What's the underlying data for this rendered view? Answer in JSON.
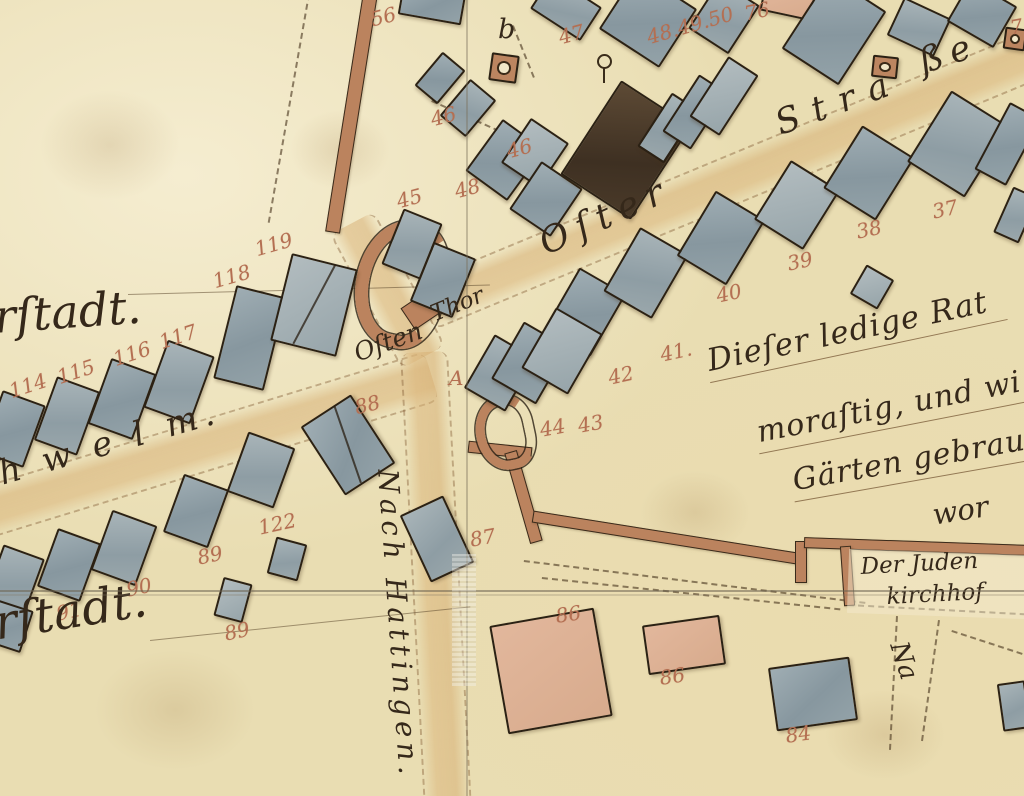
{
  "colors": {
    "parchment": "#e9ddb2",
    "building_blue": "#8f9fa8",
    "building_dark": "#4a3a29",
    "building_pink": "#dcb096",
    "wall_brown": "#bb835e",
    "number_red": "#b46f52",
    "ink": "#35281a"
  },
  "street_name": "Oſter Straße",
  "labels": [
    {
      "id": "vorstadt-label-top",
      "text": "rſtadt.",
      "x": -8,
      "y": 290,
      "rot": -4,
      "size": 46
    },
    {
      "id": "schwelm-road-label",
      "text": "h w e l m.",
      "x": -6,
      "y": 455,
      "rot": -16,
      "size": 34,
      "ls": 6
    },
    {
      "id": "vorstadt-label-bottom",
      "text": "rſtadt.",
      "x": -10,
      "y": 596,
      "rot": -9,
      "size": 48
    },
    {
      "id": "osten-thor-word1",
      "text": "Oſten",
      "x": 350,
      "y": 340,
      "rot": -20,
      "size": 25
    },
    {
      "id": "osten-thor-word2",
      "text": "Thor",
      "x": 427,
      "y": 303,
      "rot": -22,
      "size": 23
    },
    {
      "id": "street-name-oster",
      "text": "Oſter",
      "x": 533,
      "y": 226,
      "rot": -24,
      "size": 36,
      "ls": 9
    },
    {
      "id": "street-name-stra",
      "text": "Stra",
      "x": 770,
      "y": 106,
      "rot": -20,
      "size": 35,
      "ls": 14
    },
    {
      "id": "street-name-sse",
      "text": "ße",
      "x": 914,
      "y": 44,
      "rot": -18,
      "size": 35,
      "ls": 8
    },
    {
      "id": "nach-hattingen-road-label",
      "text": "Nach Hattingen.",
      "x": 404,
      "y": 468,
      "rot": 86,
      "size": 28,
      "ls": 5
    },
    {
      "id": "note-line-1",
      "text": "Dieſer ledige Rat",
      "x": 702,
      "y": 344,
      "rot": -12,
      "size": 31,
      "ls": 1,
      "cls": "underl"
    },
    {
      "id": "note-line-2",
      "text": "moraſtig, und wi",
      "x": 752,
      "y": 416,
      "rot": -11,
      "size": 30,
      "ls": 1,
      "cls": "underl"
    },
    {
      "id": "note-line-3",
      "text": "Gärten gebrau",
      "x": 788,
      "y": 464,
      "rot": -10,
      "size": 30,
      "ls": 1,
      "cls": "underl"
    },
    {
      "id": "note-line-4",
      "text": "wor",
      "x": 930,
      "y": 498,
      "rot": -9,
      "size": 29
    },
    {
      "id": "juden-kirchhof-line1",
      "text": "Der Juden",
      "x": 860,
      "y": 554,
      "rot": -3,
      "size": 23
    },
    {
      "id": "juden-kirchhof-line2",
      "text": "kirchhof",
      "x": 886,
      "y": 584,
      "rot": -3,
      "size": 23
    },
    {
      "id": "road-label-partial-na",
      "text": "Na",
      "x": 912,
      "y": 638,
      "rot": 72,
      "size": 26
    },
    {
      "id": "letter-b-well",
      "text": "b",
      "x": 498,
      "y": 14,
      "rot": 0,
      "size": 27
    }
  ],
  "numbers": [
    {
      "text": "56",
      "x": 368,
      "y": 8,
      "rot": -14
    },
    {
      "text": "47",
      "x": 556,
      "y": 26,
      "rot": -15
    },
    {
      "text": "46",
      "x": 428,
      "y": 108,
      "rot": -15
    },
    {
      "text": "46",
      "x": 504,
      "y": 140,
      "rot": -15
    },
    {
      "text": "45",
      "x": 394,
      "y": 190,
      "rot": -15
    },
    {
      "text": "48",
      "x": 452,
      "y": 180,
      "rot": -15
    },
    {
      "text": "48.49.50",
      "x": 644,
      "y": 26,
      "rot": -16
    },
    {
      "text": "76",
      "x": 742,
      "y": 2,
      "rot": -12
    },
    {
      "text": "7",
      "x": 1008,
      "y": 16,
      "rot": -10
    },
    {
      "text": "37",
      "x": 930,
      "y": 200,
      "rot": -12
    },
    {
      "text": "38",
      "x": 854,
      "y": 220,
      "rot": -12
    },
    {
      "text": "39",
      "x": 785,
      "y": 252,
      "rot": -12
    },
    {
      "text": "40",
      "x": 714,
      "y": 284,
      "rot": -12
    },
    {
      "text": "41.",
      "x": 658,
      "y": 343,
      "rot": -12
    },
    {
      "text": "42",
      "x": 606,
      "y": 366,
      "rot": -12
    },
    {
      "text": "44",
      "x": 538,
      "y": 418,
      "rot": -10
    },
    {
      "text": "43",
      "x": 576,
      "y": 414,
      "rot": -10
    },
    {
      "text": "88",
      "x": 352,
      "y": 396,
      "rot": -14
    },
    {
      "text": "87",
      "x": 468,
      "y": 528,
      "rot": -10
    },
    {
      "text": "A",
      "x": 449,
      "y": 366,
      "rot": 0
    },
    {
      "text": "114",
      "x": 6,
      "y": 380,
      "rot": -18
    },
    {
      "text": "115",
      "x": 54,
      "y": 366,
      "rot": -18
    },
    {
      "text": "116",
      "x": 110,
      "y": 348,
      "rot": -18
    },
    {
      "text": "117",
      "x": 156,
      "y": 331,
      "rot": -18
    },
    {
      "text": "118",
      "x": 210,
      "y": 270,
      "rot": -16
    },
    {
      "text": "119",
      "x": 252,
      "y": 238,
      "rot": -16
    },
    {
      "text": "122",
      "x": 256,
      "y": 516,
      "rot": -12
    },
    {
      "text": "89",
      "x": 195,
      "y": 546,
      "rot": -12
    },
    {
      "text": "90",
      "x": 124,
      "y": 578,
      "rot": -12
    },
    {
      "text": "91",
      "x": 54,
      "y": 602,
      "rot": -12
    },
    {
      "text": "89",
      "x": 222,
      "y": 622,
      "rot": -12
    },
    {
      "text": "86",
      "x": 554,
      "y": 604,
      "rot": -8
    },
    {
      "text": "86",
      "x": 658,
      "y": 666,
      "rot": -8
    },
    {
      "text": "84",
      "x": 784,
      "y": 724,
      "rot": -8
    }
  ],
  "buildings": [
    {
      "x": 400,
      "y": -12,
      "w": 64,
      "h": 32,
      "rot": 10,
      "t": "blue",
      "n": "56"
    },
    {
      "x": 536,
      "y": -12,
      "w": 60,
      "h": 40,
      "rot": 33,
      "t": "blue2"
    },
    {
      "x": 612,
      "y": -16,
      "w": 72,
      "h": 70,
      "rot": 33,
      "t": "blue"
    },
    {
      "x": 425,
      "y": 56,
      "w": 30,
      "h": 44,
      "rot": 40,
      "t": "blue"
    },
    {
      "x": 451,
      "y": 84,
      "w": 34,
      "h": 48,
      "rot": 40,
      "t": "blue2",
      "n": "46a"
    },
    {
      "x": 479,
      "y": 128,
      "w": 52,
      "h": 64,
      "rot": 36,
      "t": "blue",
      "n": "46b"
    },
    {
      "x": 391,
      "y": 214,
      "w": 42,
      "h": 60,
      "rot": 22,
      "t": "blue2",
      "n": "45"
    },
    {
      "x": 420,
      "y": 248,
      "w": 46,
      "h": 64,
      "rot": 22,
      "t": "blue",
      "n": "48"
    },
    {
      "x": 512,
      "y": 126,
      "w": 46,
      "h": 54,
      "rot": 34,
      "t": "blue3"
    },
    {
      "x": 521,
      "y": 170,
      "w": 50,
      "h": 58,
      "rot": 34,
      "t": "blue"
    },
    {
      "x": 584,
      "y": 94,
      "w": 84,
      "h": 112,
      "rot": 33,
      "t": "dark",
      "n": "47"
    },
    {
      "x": 652,
      "y": 96,
      "w": 32,
      "h": 64,
      "rot": 33,
      "t": "blue2",
      "n": "48-49-50a"
    },
    {
      "x": 678,
      "y": 78,
      "w": 34,
      "h": 68,
      "rot": 33,
      "t": "blue",
      "n": "48-49-50b"
    },
    {
      "x": 706,
      "y": 60,
      "w": 36,
      "h": 72,
      "rot": 33,
      "t": "blue3",
      "n": "48-49-50c"
    },
    {
      "x": 700,
      "y": -12,
      "w": 48,
      "h": 58,
      "rot": 33,
      "t": "blue2"
    },
    {
      "x": 762,
      "y": -14,
      "w": 52,
      "h": 30,
      "rot": 12,
      "t": "pink",
      "n": "76"
    },
    {
      "x": 800,
      "y": -14,
      "w": 68,
      "h": 88,
      "rot": 33,
      "t": "blue"
    },
    {
      "x": 893,
      "y": 6,
      "w": 52,
      "h": 42,
      "rot": 25,
      "t": "blue2"
    },
    {
      "x": 955,
      "y": -10,
      "w": 54,
      "h": 48,
      "rot": 30,
      "t": "blue"
    },
    {
      "x": 490,
      "y": 54,
      "w": 28,
      "h": 28,
      "rot": 8,
      "t": "well",
      "n": "well-b"
    },
    {
      "x": 872,
      "y": 56,
      "w": 26,
      "h": 22,
      "rot": 6,
      "t": "well",
      "n": "well-strasse"
    },
    {
      "x": 1004,
      "y": 28,
      "w": 22,
      "h": 22,
      "rot": 8,
      "t": "well",
      "n": "well-edge"
    },
    {
      "x": 558,
      "y": 276,
      "w": 54,
      "h": 72,
      "rot": 30,
      "t": "blue"
    },
    {
      "x": 618,
      "y": 236,
      "w": 56,
      "h": 74,
      "rot": 30,
      "t": "blue2"
    },
    {
      "x": 692,
      "y": 200,
      "w": 58,
      "h": 76,
      "rot": 31,
      "t": "blue"
    },
    {
      "x": 768,
      "y": 170,
      "w": 58,
      "h": 70,
      "rot": 32,
      "t": "blue3"
    },
    {
      "x": 838,
      "y": 136,
      "w": 62,
      "h": 74,
      "rot": 32,
      "t": "blue",
      "n": "38"
    },
    {
      "x": 924,
      "y": 102,
      "w": 68,
      "h": 84,
      "rot": 32,
      "t": "blue2",
      "n": "37"
    },
    {
      "x": 990,
      "y": 106,
      "w": 36,
      "h": 76,
      "rot": 28,
      "t": "blue"
    },
    {
      "x": 1002,
      "y": 190,
      "w": 28,
      "h": 50,
      "rot": 24,
      "t": "blue2"
    },
    {
      "x": 856,
      "y": 270,
      "w": 32,
      "h": 34,
      "rot": 30,
      "t": "blue3",
      "n": "39"
    },
    {
      "x": 476,
      "y": 342,
      "w": 48,
      "h": 62,
      "rot": 30,
      "t": "blue2",
      "n": "44"
    },
    {
      "x": 504,
      "y": 330,
      "w": 52,
      "h": 66,
      "rot": 30,
      "t": "blue",
      "n": "43"
    },
    {
      "x": 535,
      "y": 316,
      "w": 54,
      "h": 70,
      "rot": 30,
      "t": "blue3"
    },
    {
      "x": 318,
      "y": 404,
      "w": 60,
      "h": 82,
      "rot": -33,
      "t": "blue",
      "n": "88",
      "split": true
    },
    {
      "x": 413,
      "y": 502,
      "w": 48,
      "h": 74,
      "rot": -25,
      "t": "blue2",
      "n": "87"
    },
    {
      "x": -10,
      "y": 396,
      "w": 46,
      "h": 66,
      "rot": 20,
      "t": "blue",
      "n": "114"
    },
    {
      "x": 44,
      "y": 382,
      "w": 46,
      "h": 68,
      "rot": 20,
      "t": "blue2",
      "n": "115"
    },
    {
      "x": 98,
      "y": 364,
      "w": 48,
      "h": 70,
      "rot": 20,
      "t": "blue",
      "n": "116"
    },
    {
      "x": 154,
      "y": 346,
      "w": 50,
      "h": 72,
      "rot": 20,
      "t": "blue2",
      "n": "117"
    },
    {
      "x": 224,
      "y": 290,
      "w": 52,
      "h": 96,
      "rot": 14,
      "t": "blue",
      "n": "118"
    },
    {
      "x": 280,
      "y": 260,
      "w": 68,
      "h": 90,
      "rot": 14,
      "t": "blue3",
      "n": "119",
      "split": true
    },
    {
      "x": -8,
      "y": 550,
      "w": 44,
      "h": 60,
      "rot": 20,
      "t": "blue2"
    },
    {
      "x": 46,
      "y": 534,
      "w": 46,
      "h": 62,
      "rot": 20,
      "t": "blue",
      "n": "91"
    },
    {
      "x": 100,
      "y": 516,
      "w": 48,
      "h": 64,
      "rot": 20,
      "t": "blue2",
      "n": "90"
    },
    {
      "x": 172,
      "y": 480,
      "w": 48,
      "h": 62,
      "rot": 20,
      "t": "blue",
      "n": "89a"
    },
    {
      "x": 236,
      "y": 438,
      "w": 50,
      "h": 64,
      "rot": 20,
      "t": "blue2"
    },
    {
      "x": 218,
      "y": 580,
      "w": 30,
      "h": 40,
      "rot": 15,
      "t": "blue3",
      "n": "89b"
    },
    {
      "x": 271,
      "y": 540,
      "w": 32,
      "h": 38,
      "rot": 15,
      "t": "blue2",
      "n": "122"
    },
    {
      "x": -12,
      "y": 604,
      "w": 40,
      "h": 44,
      "rot": 18,
      "t": "blue"
    },
    {
      "x": 498,
      "y": 616,
      "w": 106,
      "h": 110,
      "rot": -10,
      "t": "pink",
      "n": "86a"
    },
    {
      "x": 645,
      "y": 620,
      "w": 78,
      "h": 50,
      "rot": -8,
      "t": "pink",
      "n": "86b"
    },
    {
      "x": 772,
      "y": 662,
      "w": 82,
      "h": 64,
      "rot": -8,
      "t": "blue",
      "n": "84"
    },
    {
      "x": 1000,
      "y": 682,
      "w": 28,
      "h": 48,
      "rot": -8,
      "t": "blue2"
    }
  ],
  "walls": [
    {
      "x": 344,
      "y": -8,
      "w": 15,
      "h": 242,
      "rot": 9
    },
    {
      "x": 468,
      "y": 444,
      "w": 64,
      "h": 12,
      "rot": 6
    },
    {
      "x": 517,
      "y": 450,
      "w": 13,
      "h": 94,
      "rot": -16
    },
    {
      "x": 531,
      "y": 532,
      "w": 274,
      "h": 12,
      "rot": 9
    },
    {
      "x": 795,
      "y": 541,
      "w": 12,
      "h": 42,
      "rot": 0
    },
    {
      "x": 804,
      "y": 541,
      "w": 224,
      "h": 11,
      "rot": 2
    },
    {
      "x": 842,
      "y": 546,
      "w": 11,
      "h": 60,
      "rot": -4
    }
  ],
  "gate": {
    "ring": {
      "x": 356,
      "y": 220,
      "w": 64,
      "h": 102,
      "rot": 12
    },
    "ring_small": {
      "x": 476,
      "y": 396,
      "w": 40,
      "h": 56,
      "rot": -12
    },
    "jamb": {
      "x": 404,
      "y": 294,
      "w": 44,
      "h": 26,
      "rot": -34
    }
  },
  "cemetery": {
    "x": 848,
    "y": 552,
    "w": 178,
    "h": 64,
    "rot": 2
  },
  "roads": [
    {
      "id": "oster-strasse-road",
      "x": 425,
      "y": 282,
      "w": 665,
      "h": 46,
      "rot": -22.5
    },
    {
      "id": "schwelm-road",
      "x": -32,
      "y": 492,
      "w": 485,
      "h": 48,
      "rot": -17
    },
    {
      "id": "hattingen-road",
      "x": 424,
      "y": 328,
      "w": 482,
      "h": 44,
      "rot": 87
    },
    {
      "id": "gate-approach-road",
      "x": 352,
      "y": 198,
      "w": 152,
      "h": 46,
      "rot": 62
    }
  ],
  "dashes": [
    {
      "x": 308,
      "y": -6,
      "h": 232,
      "rot": 10,
      "v": true
    },
    {
      "x": 655,
      "y": 28,
      "w": 124,
      "rot": -18
    },
    {
      "x": 432,
      "y": 100,
      "w": 132,
      "rot": 24
    },
    {
      "x": 512,
      "y": 26,
      "h": 56,
      "rot": -22,
      "v": true
    },
    {
      "x": 524,
      "y": 560,
      "w": 344,
      "rot": 7
    },
    {
      "x": 542,
      "y": 577,
      "w": 300,
      "rot": 6
    },
    {
      "x": 848,
      "y": 604,
      "w": 178,
      "rot": 3
    },
    {
      "x": 896,
      "y": 616,
      "h": 134,
      "rot": 3,
      "v": true
    },
    {
      "x": 938,
      "y": 620,
      "h": 122,
      "rot": 8,
      "v": true
    },
    {
      "x": 952,
      "y": 630,
      "w": 84,
      "rot": 18
    }
  ],
  "lines": [
    {
      "x": 128,
      "y": 294,
      "w": 362,
      "rot": -1.5
    },
    {
      "x": 150,
      "y": 640,
      "w": 322,
      "rot": -6
    }
  ],
  "trees": [
    {
      "x": 596,
      "y": 54,
      "w": 14,
      "h": 30,
      "rot": 0
    }
  ],
  "stains": [
    {
      "x": 40,
      "y": 90,
      "w": 140,
      "h": 110
    },
    {
      "x": 290,
      "y": 110,
      "w": 100,
      "h": 80
    },
    {
      "x": 95,
      "y": 650,
      "w": 160,
      "h": 120
    },
    {
      "x": 640,
      "y": 470,
      "w": 110,
      "h": 85
    },
    {
      "x": 825,
      "y": 690,
      "w": 120,
      "h": 90
    }
  ]
}
